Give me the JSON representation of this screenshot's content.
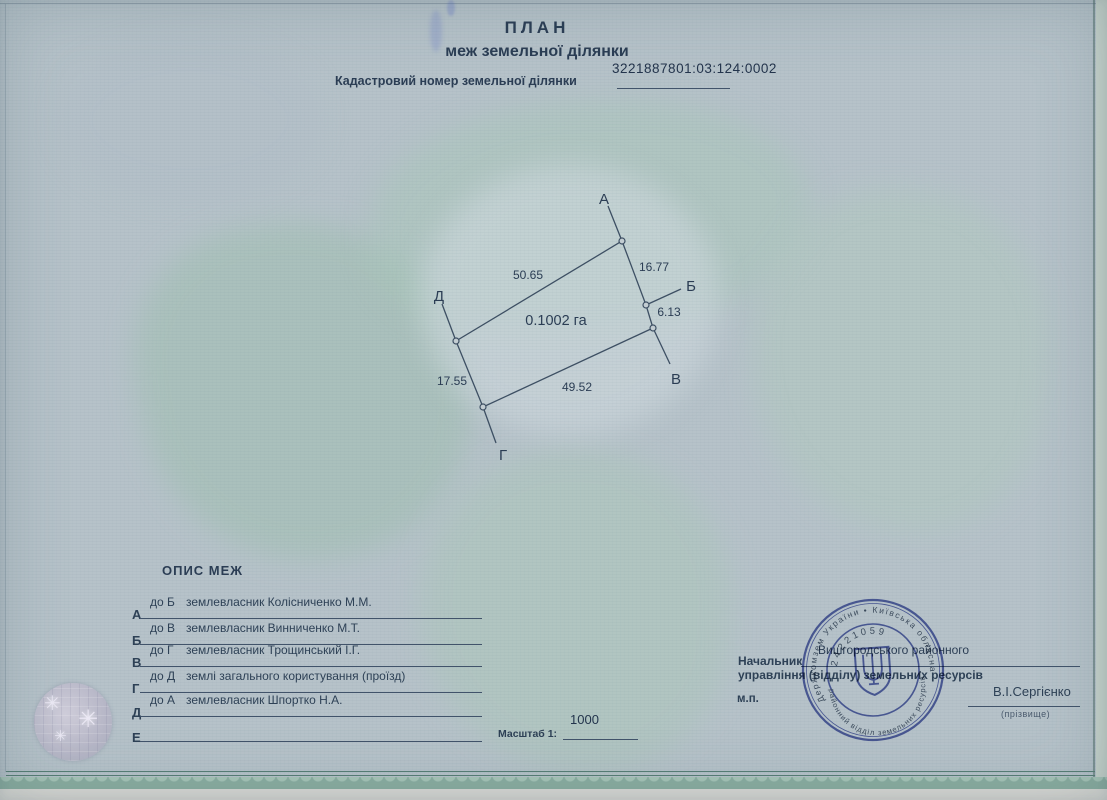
{
  "header": {
    "title": "ПЛАН",
    "subtitle": "меж земельної ділянки",
    "cadastral_number": "3221887801:03:124:0002",
    "cadastral_label": "Кадастровий номер земельної ділянки"
  },
  "plot": {
    "area_label": "0.1002 га",
    "vertex_labels": {
      "a": "А",
      "b": "Б",
      "v": "В",
      "g": "Г",
      "d": "Д"
    },
    "measurements": {
      "da": "50.65",
      "ab": "16.77",
      "bv": "6.13",
      "gv": "49.52",
      "dg": "17.55"
    }
  },
  "opys": {
    "title": "ОПИС МЕЖ",
    "rows": [
      {
        "letter": "А",
        "dir": "до Б",
        "desc": "землевласник Колісниченко М.М."
      },
      {
        "letter": "Б",
        "dir": "до В",
        "desc": "землевласник Винниченко М.Т."
      },
      {
        "letter": "В",
        "dir": "до Г",
        "desc": "землевласник Трощинський І.Г."
      },
      {
        "letter": "Г",
        "dir": "до Д",
        "desc": "землі загального користування (проїзд)"
      },
      {
        "letter": "Д",
        "dir": "до А",
        "desc": "землевласник Шпортко Н.А."
      },
      {
        "letter": "Е",
        "dir": "",
        "desc": ""
      }
    ]
  },
  "scale": {
    "label": "Масштаб 1:",
    "value": "1000"
  },
  "officials": {
    "chief_label": "Начальник",
    "filled_office": "Вишгородського районного",
    "department_line": "управління (відділу) земельних ресурсів",
    "seal_abbr": "м.п.",
    "signature_name": "В.І.Сергієнко",
    "signature_caption": "(прізвище)"
  },
  "stamp": {
    "ring_outer": "Держкомзем України • Київська обласна •",
    "ring_inner": "районний відділ земельних ресурсів • Вишгородська •",
    "code": "24221059",
    "emblem": "trident"
  },
  "colors": {
    "paper": "#b6c2c9",
    "watermark_green": "#b9cec4",
    "ink": "#2e4156",
    "stamp_blue": "#4050a8",
    "frame_green": "#567e74"
  }
}
